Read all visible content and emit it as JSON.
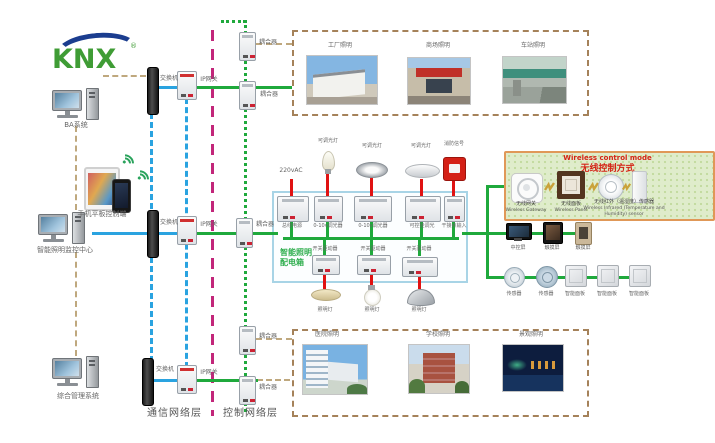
{
  "logo": {
    "text": "KNX",
    "reg": "®"
  },
  "clients": {
    "ba_system": "BA系统",
    "mobile": "手机平板控制端",
    "monitor_center": "智能照明监控中心",
    "management": "综合管理系统"
  },
  "network": {
    "switch": "交换机",
    "gateway": "IP网关",
    "coupler": "耦合器",
    "comm_layer": "通信网络层",
    "ctrl_layer": "控制网络层"
  },
  "cabinet": {
    "name_line1": "智能照明",
    "name_line2": "配电箱",
    "mains": "220vAC",
    "modules_top": [
      "总线电源",
      "0-10v调光器",
      "0-10v调光器",
      "可控硅调光",
      "干接点输入"
    ],
    "loads_top": [
      "可调光灯",
      "可调光灯",
      "可调光灯",
      "消防信号"
    ],
    "modules_bottom": [
      "开关驱动器",
      "开关驱动器",
      "开关驱动器"
    ],
    "loads_bottom": [
      "照明灯",
      "照明灯",
      "照明灯"
    ]
  },
  "applications_top": [
    {
      "label": "工厂照明"
    },
    {
      "label": "商场照明"
    },
    {
      "label": "车站照明"
    }
  ],
  "applications_bottom": [
    {
      "label": "医院照明"
    },
    {
      "label": "学校照明"
    },
    {
      "label": "景观照明"
    }
  ],
  "wireless": {
    "title_en": "Wireless control mode",
    "title_zh": "无线控制方式",
    "items": [
      {
        "zh": "无线网关",
        "en": "Wireless Gateway"
      },
      {
        "zh": "无线面板",
        "en": "Wireless Panel"
      },
      {
        "zh": "无线红外（温湿度）传感器",
        "en": "Wireless Infrared (Temperature and Humidity) sensor"
      }
    ]
  },
  "devices": {
    "central_screen": "中控屏",
    "touch_screen": "触摸屏",
    "sensor": "传感器",
    "smart_panel": "智能面板"
  },
  "colors": {
    "bus_green": "#1fa93c",
    "lan_blue": "#2aa3e0",
    "layer_magenta": "#c2267a",
    "load_red": "#e01212",
    "dashed_tan": "#bfa87e",
    "cabinet_blue": "#a8d4e6",
    "wireless_border": "#e09858",
    "wireless_bg": "#dfeccb",
    "knx_green": "#3f9c35",
    "knx_blue": "#1b3d8f"
  }
}
